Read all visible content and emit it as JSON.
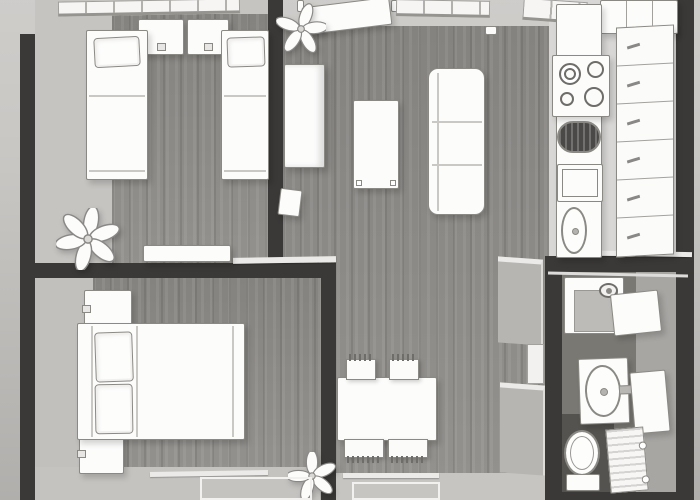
{
  "meta": {
    "title": "Apartment 3D floor plan, top-down view",
    "view": "overhead 3D render, sketch style",
    "no_visible_text": true
  },
  "colors": {
    "background": "#c9c7c4",
    "wall": "#3b3937",
    "wood_floor": "#8d8b87",
    "light_floor": "#c6c4c1",
    "kitchen_floor": "#d8d7d5",
    "bathroom_floor": "#7a7873",
    "bathroom_floor_dark": "#55534f",
    "bathroom_floor_light": "#a8a6a3",
    "furniture": "#fcfcfb",
    "outline": "#8b8984",
    "trim": "#eceae8"
  },
  "rooms": [
    {
      "id": "bedroom-twin",
      "label": "Bedroom with two single beds",
      "furniture": [
        "window",
        "dresser",
        "dresser",
        "single bed with pillow",
        "single bed with pillow",
        "plant",
        "sideboard"
      ]
    },
    {
      "id": "living-room",
      "label": "Living and dining room",
      "furniture": [
        "entry door",
        "plant",
        "window",
        "tall cabinet",
        "small cabinet",
        "coffee table",
        "sofa",
        "dining table",
        "4 chairs",
        "plant",
        "rug"
      ]
    },
    {
      "id": "kitchen",
      "label": "Kitchen",
      "furniture": [
        "upper cabinets",
        "window",
        "cooktop with 4 burners",
        "dark sink basin",
        "oven",
        "oval sink",
        "drawer column"
      ]
    },
    {
      "id": "bedroom-double",
      "label": "Bedroom with double bed",
      "furniture": [
        "nightstand",
        "nightstand",
        "double bed with two pillows",
        "rug"
      ]
    },
    {
      "id": "bathroom",
      "label": "Bathroom",
      "furniture": [
        "shower with shower head",
        "washing machine",
        "sink vanity",
        "mirror cabinet",
        "toilet",
        "radiator"
      ]
    }
  ]
}
